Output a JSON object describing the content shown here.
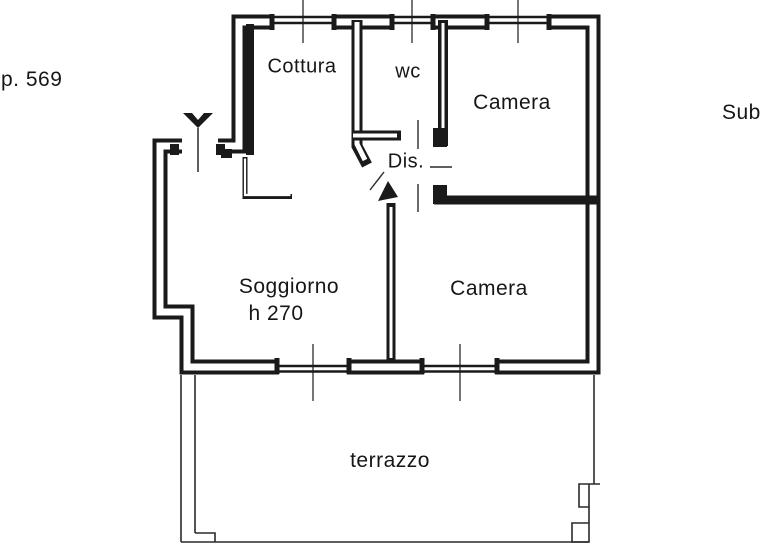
{
  "canvas": {
    "width": 768,
    "height": 560,
    "background": "#ffffff",
    "line_color": "#1a1a1a"
  },
  "annotations": {
    "page_ref": "p. 569",
    "sub_ref": "Sub"
  },
  "rooms": {
    "cottura": {
      "label": "Cottura"
    },
    "wc": {
      "label": "wc"
    },
    "camera_nord": {
      "label": "Camera"
    },
    "disimpegno": {
      "label": "Dis."
    },
    "soggiorno": {
      "label": "Soggiorno",
      "height_note": "h 270"
    },
    "camera_sud": {
      "label": "Camera"
    },
    "terrazzo": {
      "label": "terrazzo"
    }
  },
  "symbols": {
    "entrance_marker": "entrance-triangle",
    "entry_arrow": "entry-direction-arrow",
    "windows_count": 5
  }
}
